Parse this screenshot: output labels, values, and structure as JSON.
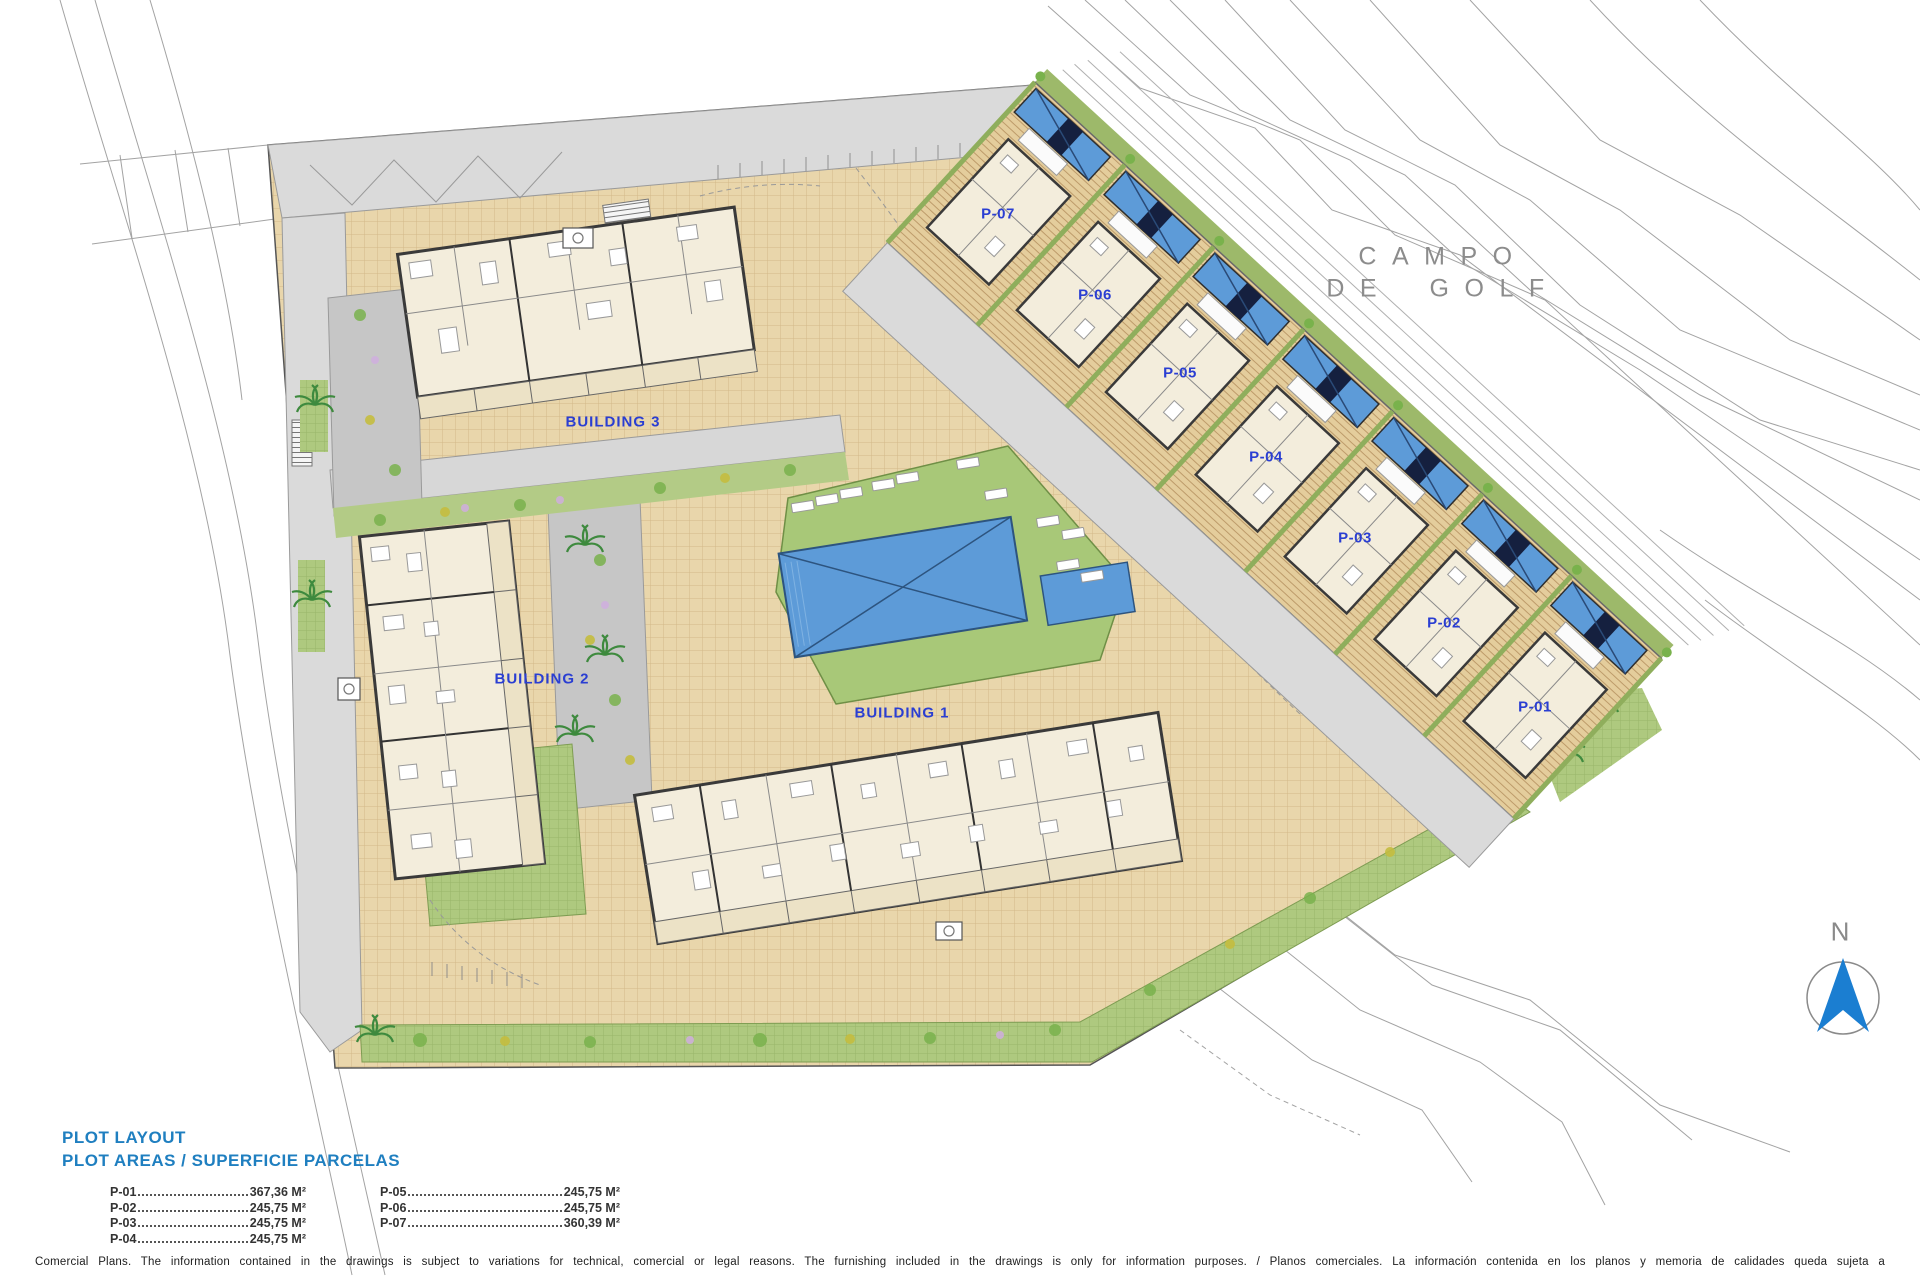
{
  "map": {
    "golf_label_line1": "CAMPO",
    "golf_label_line2": "DE GOLF",
    "north_label": "N",
    "buildings": [
      {
        "id": "building-1",
        "label": "BUILDING 1"
      },
      {
        "id": "building-2",
        "label": "BUILDING 2"
      },
      {
        "id": "building-3",
        "label": "BUILDING 3"
      }
    ],
    "plots": [
      {
        "id": "P-01",
        "label": "P-01"
      },
      {
        "id": "P-02",
        "label": "P-02"
      },
      {
        "id": "P-03",
        "label": "P-03"
      },
      {
        "id": "P-04",
        "label": "P-04"
      },
      {
        "id": "P-05",
        "label": "P-05"
      },
      {
        "id": "P-06",
        "label": "P-06"
      },
      {
        "id": "P-07",
        "label": "P-07"
      }
    ]
  },
  "legend": {
    "title": "PLOT LAYOUT",
    "subtitle": "PLOT AREAS / SUPERFICIE PARCELAS",
    "columns": [
      {
        "rows": [
          {
            "label": "P-01",
            "value": "367,36 M²"
          },
          {
            "label": "P-02",
            "value": "245,75 M²"
          },
          {
            "label": "P-03",
            "value": "245,75 M²"
          },
          {
            "label": "P-04",
            "value": "245,75 M²"
          }
        ]
      },
      {
        "rows": [
          {
            "label": "P-05",
            "value": "245,75 M²"
          },
          {
            "label": "P-06",
            "value": "245,75 M²"
          },
          {
            "label": "P-07",
            "value": "360,39 M²"
          }
        ]
      }
    ]
  },
  "footer": {
    "disclaimer": "Comercial Plans. The information contained in the drawings is subject to variations for technical, comercial or legal reasons. The furnishing included in the drawings is only for information purposes. / Planos comerciales. La información contenida en los planos y memoria de calidades queda sujeta a"
  },
  "colors": {
    "map_label_blue": "#2a3ed2",
    "legend_heading_blue": "#1f7fc0",
    "pool_blue": "#5d9bd8",
    "north_arrow_blue": "#1b7ed1"
  }
}
